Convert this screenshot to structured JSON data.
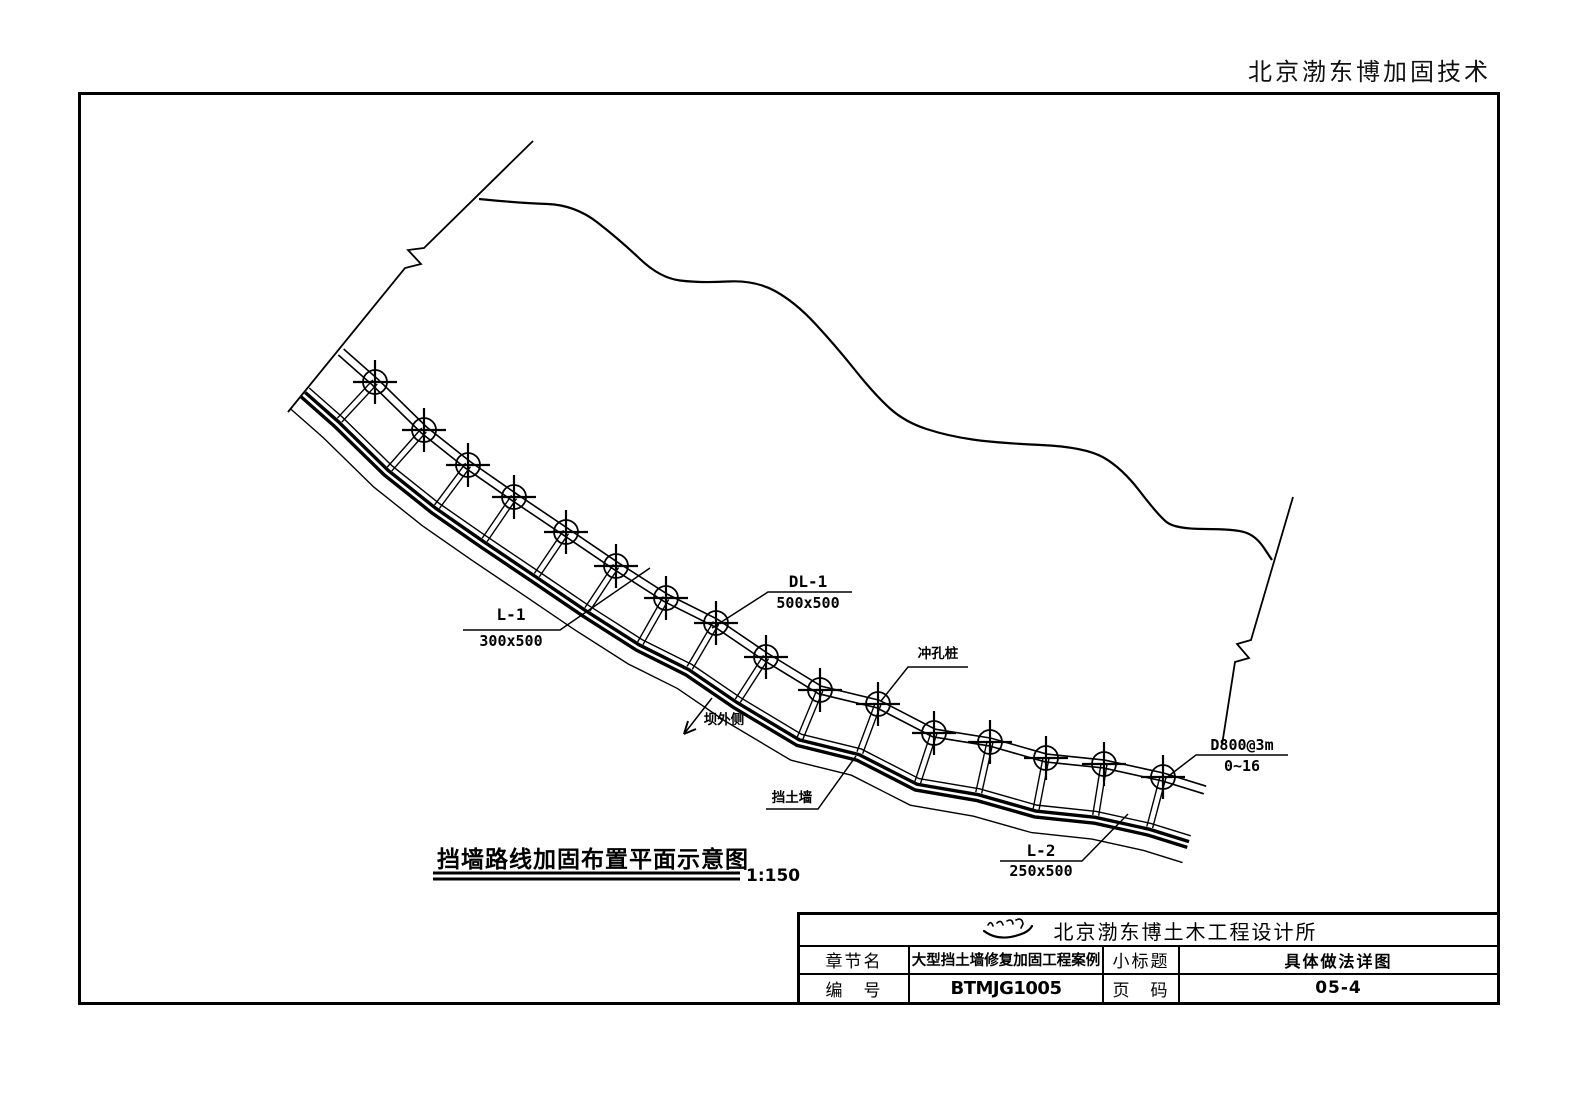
{
  "page": {
    "brand_header": "北京渤东博加固技术"
  },
  "drawing": {
    "title": "挡墙路线加固布置平面示意图",
    "scale": "1:150",
    "labels": {
      "tie_beam_1": {
        "name": "L-1",
        "size": "300x500"
      },
      "crown_beam": {
        "name": "DL-1",
        "size": "500x500"
      },
      "tie_beam_2": {
        "name": "L-2",
        "size": "250x500"
      },
      "punched_pile": {
        "name": "冲孔桩"
      },
      "dam_outer_side": {
        "name": "坝外侧"
      },
      "retaining_wall": {
        "name": "挡土墙"
      },
      "pile_spec": {
        "name": "D800@3m",
        "range": "0~16"
      }
    },
    "ink_color": "#000000",
    "geometry": {
      "beam_centerline": [
        [
          341,
          352
        ],
        [
          375,
          382
        ],
        [
          424,
          430
        ],
        [
          468,
          465
        ],
        [
          514,
          497
        ],
        [
          566,
          532
        ],
        [
          616,
          566
        ],
        [
          666,
          598
        ],
        [
          716,
          623
        ],
        [
          766,
          657
        ],
        [
          820,
          690
        ],
        [
          878,
          704
        ],
        [
          934,
          733
        ],
        [
          990,
          742
        ],
        [
          1046,
          758
        ],
        [
          1104,
          764
        ],
        [
          1163,
          777
        ],
        [
          1205,
          790
        ]
      ],
      "pile_index_start": 1,
      "pile_index_end": 16,
      "offsets": {
        "beam": [
          -4,
          4
        ],
        "wall_top": 48,
        "wall_band": [
          54,
          60
        ],
        "wall_outer": 76,
        "tie_length": 52,
        "tie_half_gap": 3
      },
      "pile_symbol": {
        "radius": 12,
        "cross_half": 22
      },
      "contour": [
        [
          479,
          199
        ],
        [
          520,
          203
        ],
        [
          575,
          205
        ],
        [
          620,
          240
        ],
        [
          660,
          278
        ],
        [
          700,
          283
        ],
        [
          755,
          280
        ],
        [
          795,
          302
        ],
        [
          835,
          345
        ],
        [
          875,
          395
        ],
        [
          905,
          422
        ],
        [
          948,
          436
        ],
        [
          997,
          443
        ],
        [
          1085,
          447
        ],
        [
          1122,
          468
        ],
        [
          1158,
          515
        ],
        [
          1175,
          529
        ],
        [
          1235,
          529
        ],
        [
          1256,
          536
        ],
        [
          1272,
          560
        ]
      ],
      "break_line_left": [
        [
          533,
          141
        ],
        [
          424,
          248
        ],
        [
          408,
          250
        ],
        [
          421,
          264
        ],
        [
          405,
          268
        ],
        [
          288,
          412
        ]
      ],
      "break_line_right": [
        [
          1293,
          497
        ],
        [
          1251,
          640
        ],
        [
          1237,
          644
        ],
        [
          1249,
          658
        ],
        [
          1235,
          662
        ],
        [
          1222,
          745
        ]
      ],
      "leaders": [
        {
          "for": "tie_beam_1",
          "points": [
            [
              463,
              630
            ],
            [
              560,
              630
            ],
            [
              650,
              568
            ]
          ]
        },
        {
          "for": "crown_beam",
          "points": [
            [
              852,
              592
            ],
            [
              768,
              592
            ],
            [
              712,
              628
            ]
          ]
        },
        {
          "for": "punched_pile",
          "points": [
            [
              968,
              667
            ],
            [
              908,
              667
            ],
            [
              881,
              701
            ]
          ]
        },
        {
          "for": "retaining_wall",
          "points": [
            [
              766,
              809
            ],
            [
              818,
              809
            ],
            [
              856,
              756
            ]
          ]
        },
        {
          "for": "pile_spec",
          "points": [
            [
              1288,
              755
            ],
            [
              1196,
              755
            ],
            [
              1166,
              778
            ]
          ]
        },
        {
          "for": "tie_beam_2",
          "points": [
            [
              1000,
              861
            ],
            [
              1082,
              861
            ],
            [
              1128,
              814
            ]
          ]
        }
      ],
      "arrow_dam_outer": {
        "shaft": [
          [
            712,
            698
          ],
          [
            684,
            734
          ]
        ],
        "head": [
          [
            [
              684,
              734
            ],
            [
              696,
              729
            ]
          ],
          [
            [
              684,
              734
            ],
            [
              688,
              721
            ]
          ]
        ]
      },
      "title_underline": [
        [
          [
            433,
            873
          ],
          [
            740,
            873
          ]
        ],
        [
          [
            433,
            879
          ],
          [
            740,
            879
          ]
        ]
      ]
    }
  },
  "title_block": {
    "company": "北京渤东博土木工程设计所",
    "logo_icon": "calligraphy-signature",
    "rows": {
      "chapter_label": "章节名",
      "chapter_value": "大型挡土墙修复加固工程案例",
      "subtitle_label": "小标题",
      "subtitle_value": "具体做法详图",
      "number_label": "编　号",
      "number_value": "BTMJG1005",
      "page_label": "页　码",
      "page_value": "05-4"
    }
  }
}
